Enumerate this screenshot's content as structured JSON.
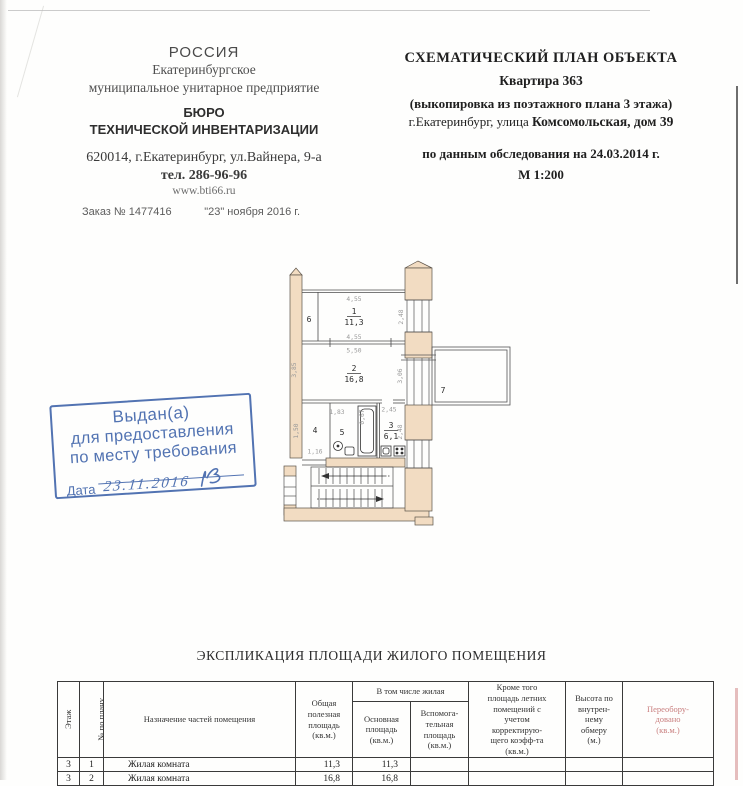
{
  "letterhead": {
    "country": "РОССИЯ",
    "org_line1": "Екатеринбургское",
    "org_line2": "муниципальное унитарное предприятие",
    "bureau_line1": "БЮРО",
    "bureau_line2": "ТЕХНИЧЕСКОЙ ИНВЕНТАРИЗАЦИИ",
    "address": "620014, г.Екатеринбург, ул.Вайнера, 9-а",
    "phone": "тел. 286-96-96",
    "website": "www.bti66.ru",
    "order": "Заказ № 1477416",
    "order_date": "\"23\" ноября 2016 г."
  },
  "title_block": {
    "title": "СХЕМАТИЧЕСКИЙ ПЛАН ОБЪЕКТА",
    "apartment": "Квартира 363",
    "extract": "(выкопировка из поэтажного плана 3 этажа)",
    "city_prefix": "г.Екатеринбург, улица ",
    "street_bold": "Комсомольская, дом 39",
    "survey": "по данным обследования на 24.03.2014 г.",
    "scale": "М 1:200"
  },
  "stamp": {
    "line1": "Выдан(а)",
    "line2": "для предоставления",
    "line3": "по месту требования",
    "date_label": "Дата",
    "date_value": "23.11.2016"
  },
  "plan": {
    "rooms": {
      "r1_num": "1",
      "r1_area": "11,3",
      "r2_num": "2",
      "r2_area": "16,8",
      "r3_num": "3",
      "r3_area": "6,1",
      "r4_num": "4",
      "r5_num": "5",
      "r6_num": "6",
      "r7_num": "7"
    },
    "dims": {
      "room1_top": "4,55",
      "room1_bottom": "4,55",
      "room1_right": "2,48",
      "room2_top": "5,50",
      "room2_left": "3,85",
      "room2_right": "3,06",
      "room3_top": "2,45",
      "room3_right": "2,48",
      "room4_left": "1,50",
      "room4_bottom": "1,16",
      "room5_top": "1,83",
      "bath_width": "0,67"
    }
  },
  "table": {
    "title": "ЭКСПЛИКАЦИЯ ПЛОЩАДИ ЖИЛОГО ПОМЕЩЕНИЯ",
    "headers": {
      "col_floor": "Этаж",
      "col_plan_no": "№ по плану",
      "col_purpose": "Назначение частей помещения",
      "col_total": "Общая\nполезная\nплощадь\n(кв.м.)",
      "group_living": "В том числе жилая",
      "col_main": "Основная\nплощадь\n(кв.м.)",
      "col_aux": "Вспомога-\nтельная\nплощадь\n(кв.м.)",
      "col_summer": "Кроме того\nплощадь летних\nпомещений с\nучетом\nкорректирую-\nщего коэфф-та\n(кв.м.)",
      "col_height": "Высота по\nвнутрен-\nнему\nобмеру\n(м.)",
      "col_reequipped": "Переобору-\nдовано\n(кв.м.)"
    },
    "rows": [
      {
        "floor": "3",
        "no": "1",
        "purpose": "Жилая комната",
        "total": "11,3",
        "main": "11,3",
        "aux": "",
        "summer": "",
        "height": "",
        "reequipped": ""
      },
      {
        "floor": "3",
        "no": "2",
        "purpose": "Жилая комната",
        "total": "16,8",
        "main": "16,8",
        "aux": "",
        "summer": "",
        "height": "",
        "reequipped": ""
      }
    ]
  },
  "colors": {
    "stamp_blue": "#4468ac",
    "wall_fill": "#f2dcc2",
    "reequipped_red": "#c97f7f"
  }
}
